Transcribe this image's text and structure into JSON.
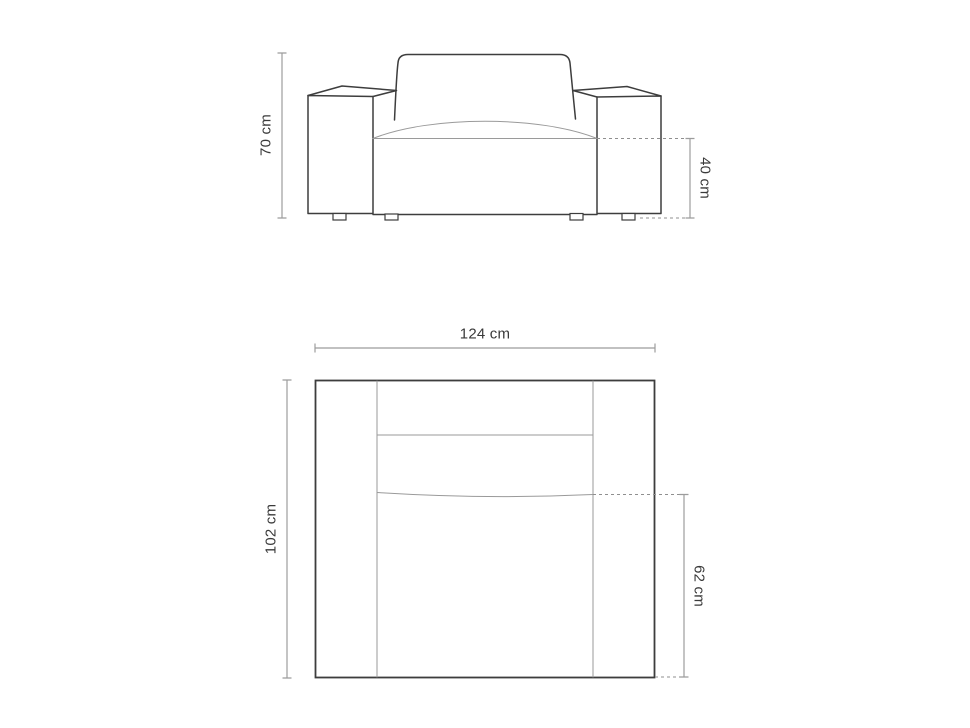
{
  "diagram": {
    "front_view": {
      "height_label": "70 cm",
      "seat_height_label": "40 cm"
    },
    "top_view": {
      "width_label": "124 cm",
      "depth_label": "102 cm",
      "seat_depth_label": "62 cm"
    }
  },
  "colors": {
    "background": "#ffffff",
    "outline": "#3d3d3d",
    "thin_line": "#9a9a9a",
    "dimension_line": "#9c9c9c",
    "dashed_line": "#8f8f8f",
    "label_text": "#3a3a3a"
  }
}
